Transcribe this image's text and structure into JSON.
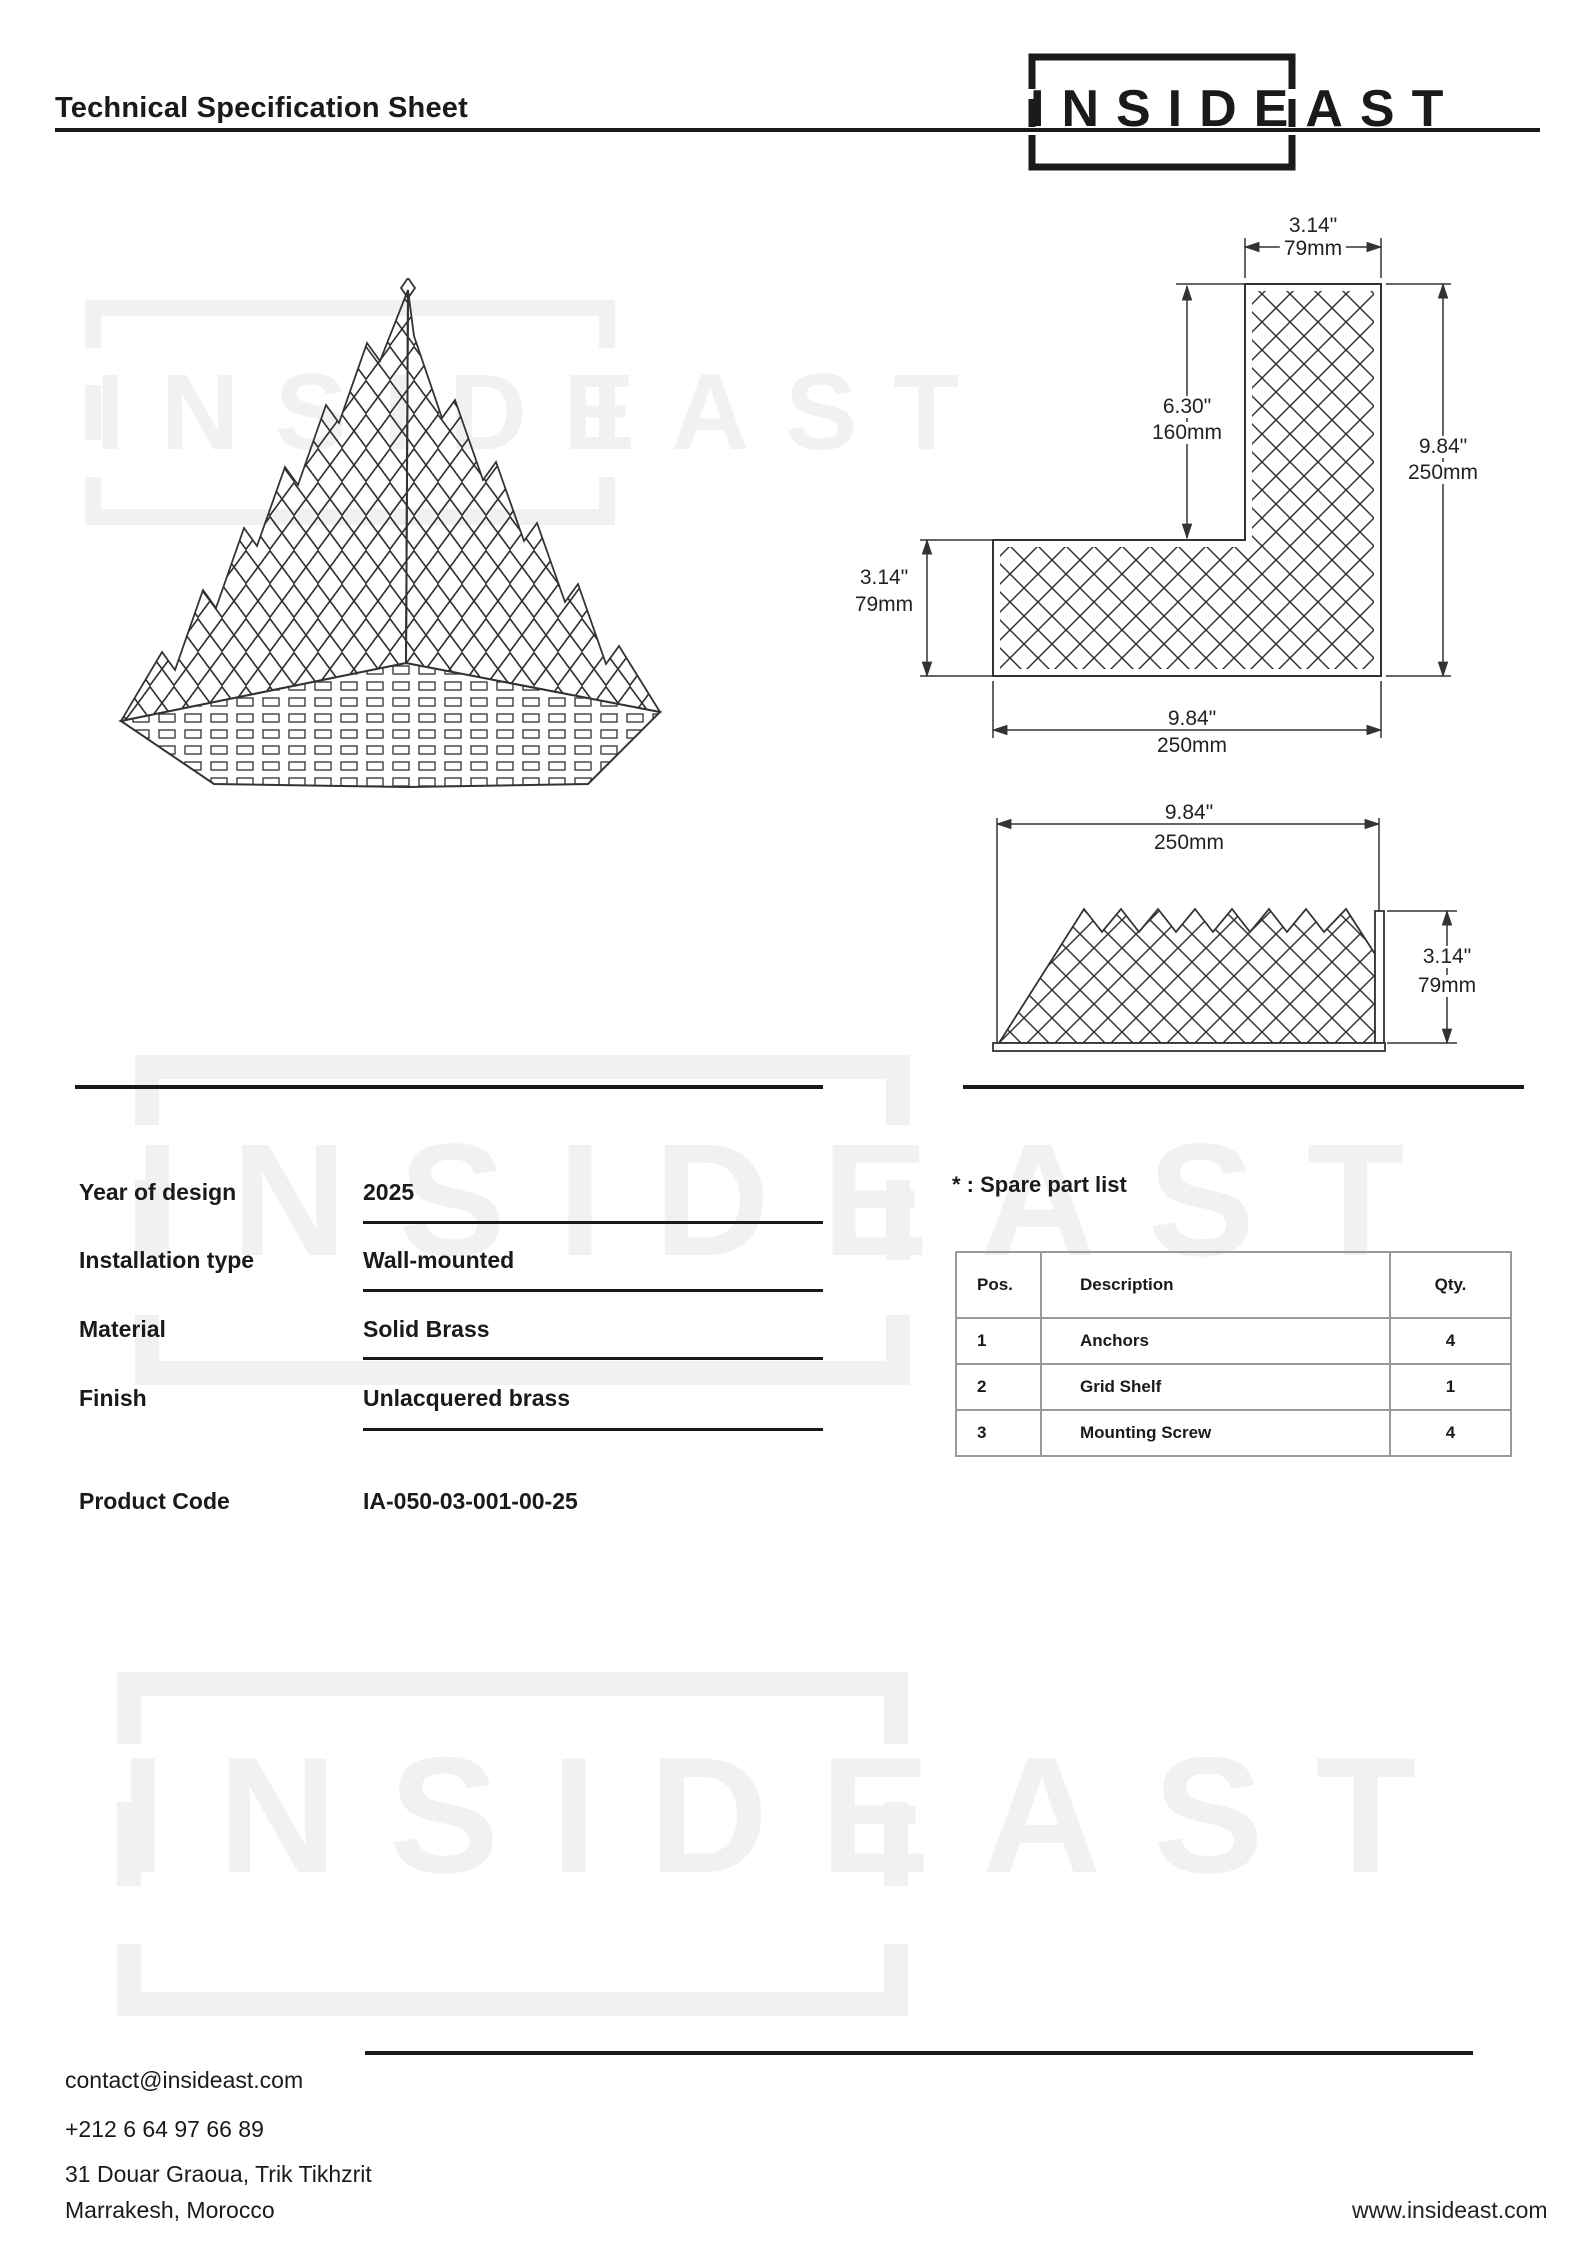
{
  "header": {
    "title": "Technical Specification Sheet",
    "brand": "INSIDEAST"
  },
  "watermark": {
    "text": "INSIDEAST"
  },
  "dims": {
    "in314": "3.14\"",
    "mm79": "79mm",
    "in630": "6.30\"",
    "mm160": "160mm",
    "in984": "9.84\"",
    "mm250": "250mm"
  },
  "specs": {
    "rows": [
      {
        "label": "Year of design",
        "value": "2025"
      },
      {
        "label": "Installation type",
        "value": "Wall-mounted"
      },
      {
        "label": "Material",
        "value": "Solid Brass"
      },
      {
        "label": "Finish",
        "value": "Unlacquered brass"
      }
    ],
    "product_code": {
      "label": "Product Code",
      "value": "IA-050-03-001-00-25"
    }
  },
  "spare_parts": {
    "heading": "* : Spare part list",
    "columns": [
      "Pos.",
      "Description",
      "Qty."
    ],
    "rows": [
      [
        "1",
        "Anchors",
        "4"
      ],
      [
        "2",
        "Grid Shelf",
        "1"
      ],
      [
        "3",
        "Mounting Screw",
        "4"
      ]
    ]
  },
  "footer": {
    "email": "contact@insideast.com",
    "phone": "+212 6 64 97 66 89",
    "address1": "31 Douar Graoua, Trik Tikhzrit",
    "address2": "Marrakesh, Morocco",
    "website": "www.insideast.com"
  }
}
